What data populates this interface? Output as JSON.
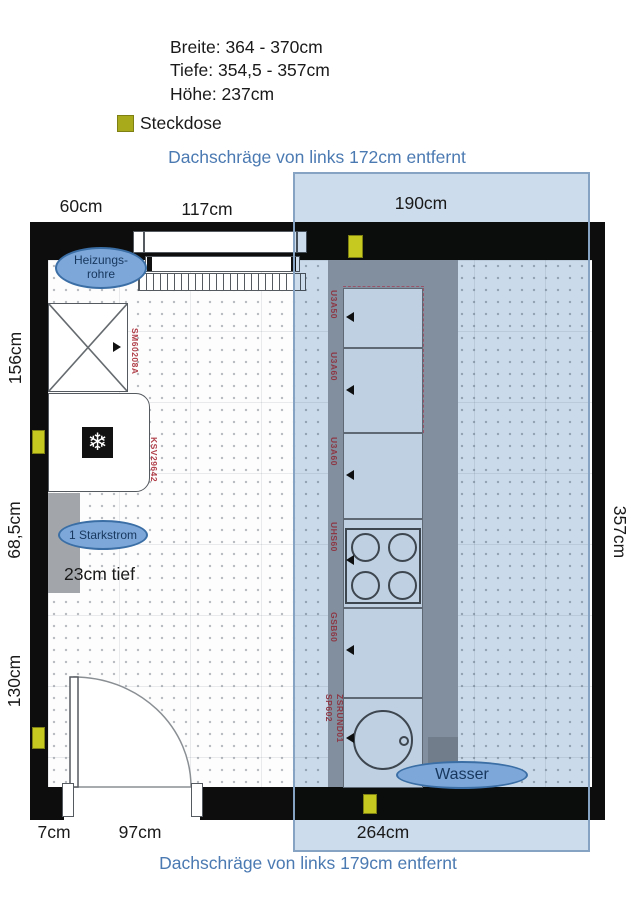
{
  "specs": {
    "breite": "Breite: 364 - 370cm",
    "tiefe": "Tiefe: 354,5 - 357cm",
    "hoehe": "Höhe: 237cm"
  },
  "legend": {
    "steckdose": "Steckdose"
  },
  "slope": {
    "top": "Dachschräge von links 172cm entfernt",
    "bottom": "Dachschräge von links 179cm entfernt"
  },
  "dims": {
    "top": [
      "60cm",
      "117cm",
      "190cm"
    ],
    "left": [
      "156cm",
      "68,5cm",
      "130cm"
    ],
    "right": "357cm",
    "bottom": [
      "7cm",
      "97cm",
      "264cm"
    ]
  },
  "annotations": {
    "heizung_line1": "Heizungs-",
    "heizung_line2": "rohre",
    "starkstrom": "1 Starkstrom",
    "tief": "23cm tief",
    "wasser": "Wasser"
  },
  "units": {
    "sideboard": "SM60208A",
    "fridge": "KSV29642",
    "run": [
      "U3A50",
      "U3A60",
      "U3A60",
      "UHS60",
      "GSB60"
    ],
    "sink_a": "SP602",
    "sink_b": "ZSRUND01"
  },
  "icons": {
    "snowflake": "❄"
  },
  "colors": {
    "accent_blue": "#4b7ab2",
    "steckdose_legend": "#a8aa1c",
    "steckdose_wall": "#c6ca20",
    "overlay_blue": "#ccdcec",
    "unit_label_red": "#b0404a",
    "wall_black": "#0d0d0d"
  }
}
